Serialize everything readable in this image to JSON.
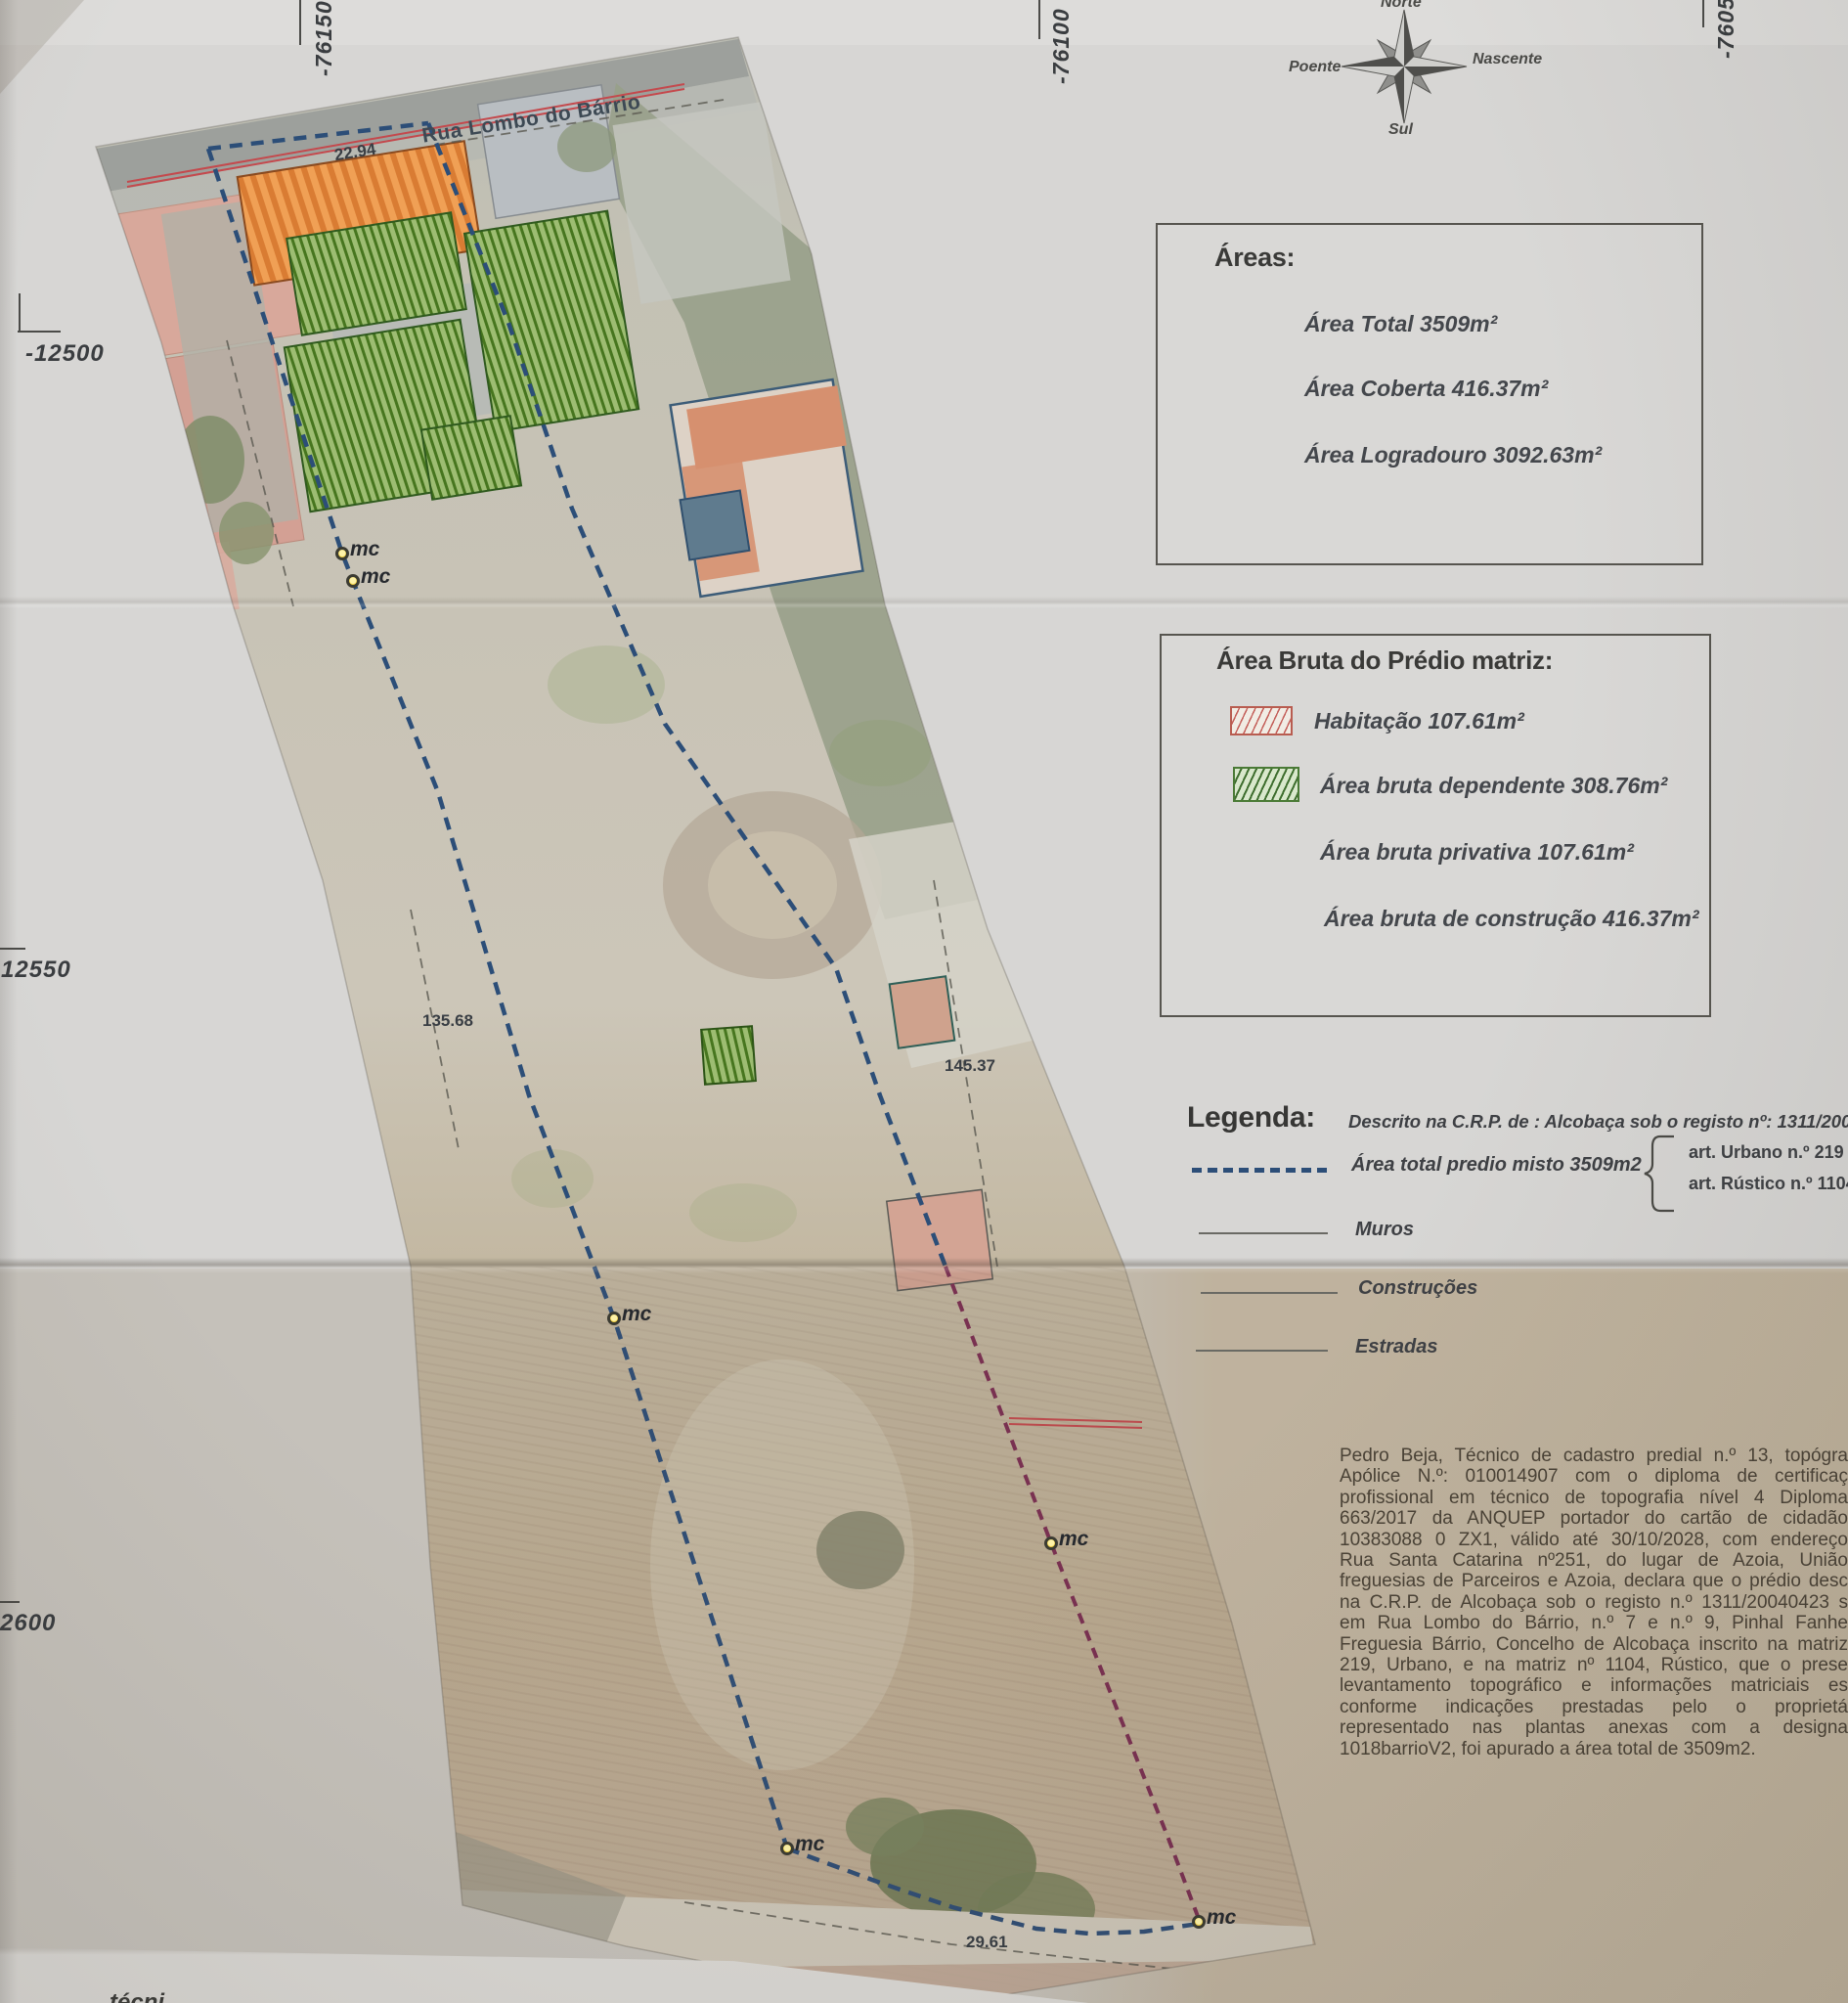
{
  "compass": {
    "north": "Norte",
    "east": "Nascente",
    "south": "Sul",
    "west": "Poente"
  },
  "grid_coords": {
    "top": [
      "-76150",
      "-76100",
      "-76050"
    ],
    "left": [
      "-12500",
      "-12550",
      "2600"
    ]
  },
  "map": {
    "street": "Rua Lombo do Bárrio",
    "dim_road": "22.94",
    "dim_west": "135.68",
    "dim_east": "145.37",
    "dim_south": "29.61",
    "marker_label": "mc",
    "edge_fragment": "técni"
  },
  "areas_box": {
    "title": "Áreas:",
    "total": "Área Total 3509m²",
    "coberta": "Área Coberta 416.37m²",
    "logradouro": "Área Logradouro 3092.63m²"
  },
  "bruta_box": {
    "title": "Área Bruta do Prédio matriz:",
    "habitacao": "Habitação 107.61m²",
    "dependente": "Área bruta dependente 308.76m²",
    "privativa": "Área bruta privativa 107.61m²",
    "construcao": "Área bruta de construção 416.37m²"
  },
  "legend": {
    "title": "Legenda:",
    "descricao": "Descrito na C.R.P. de : Alcobaça sob o registo nº: 1311/2004",
    "parcela": "Área total predio misto 3509m2",
    "art_urbano": "art.  Urbano n.º 219",
    "art_rustico": "art.  Rústico n.º 1104",
    "muros": "Muros",
    "construcoes": "Construções",
    "estradas": "Estradas"
  },
  "declaration": {
    "lines": [
      "Pedro Beja, Técnico de cadastro predial n.º 13, topógra",
      "Apólice N.º: 010014907 com o diploma de certificaç",
      "profissional em técnico de topografia nível 4 Diploma",
      "663/2017 da ANQUEP portador do cartão de cidadão",
      "10383088 0 ZX1, válido até 30/10/2028, com endereço",
      "Rua Santa Catarina nº251, do lugar de Azoia, União",
      "freguesias de Parceiros e Azoia, declara que o prédio desc",
      "na C.R.P. de Alcobaça sob o registo n.º 1311/20040423 s",
      "em Rua Lombo do Bárrio, n.º 7 e n.º 9, Pinhal Fanhe",
      "Freguesia Bárrio, Concelho de Alcobaça inscrito na matriz",
      "219, Urbano, e na matriz nº 1104, Rústico, que o prese",
      "levantamento topográfico e informações matriciais es",
      "conforme indicações prestadas pelo o proprietá",
      "representado nas plantas anexas com a designa",
      "1018barrioV2, foi apurado a área total de 3509m2."
    ]
  },
  "colors": {
    "boundary_blue": "#2c4e78",
    "register_purple": "#7c2e52",
    "road_red": "#c4494d",
    "marker_yellow": "#eec92f",
    "hatch_red_border": "#b85c50",
    "hatch_green": "#3e6e2e",
    "paper": "#d7d6d4",
    "paper_tan": "#c7b9a3"
  }
}
